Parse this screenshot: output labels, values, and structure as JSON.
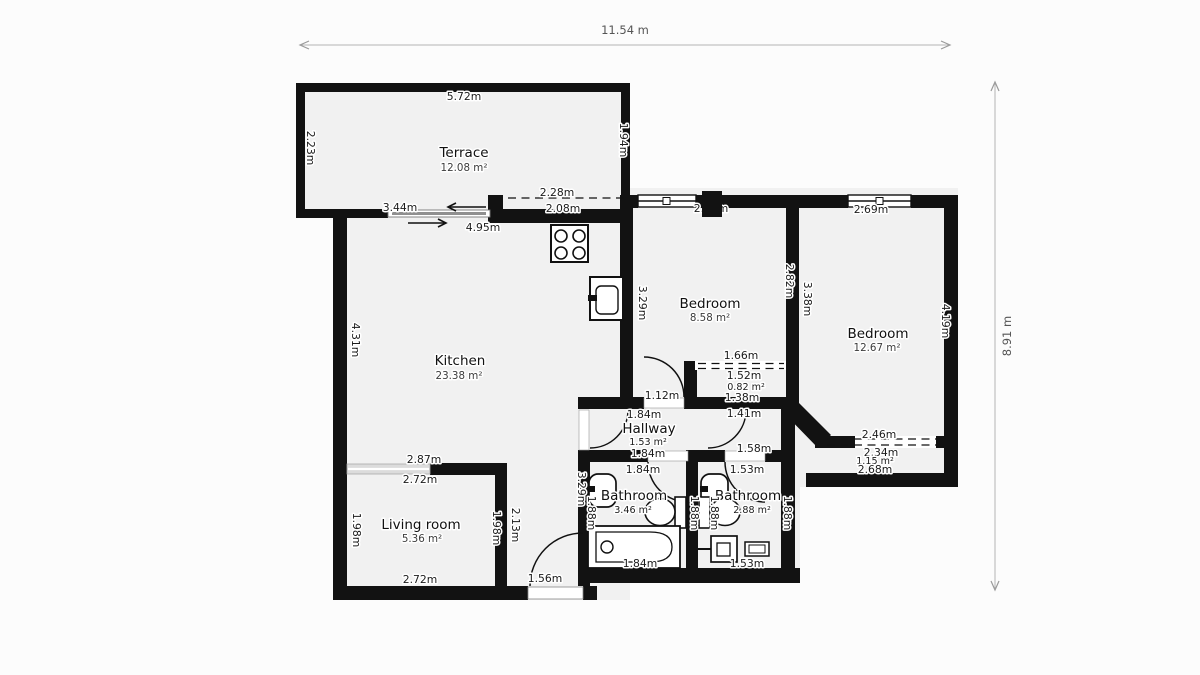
{
  "meta": {
    "width_label": "11.54 m",
    "height_label": "8.91 m"
  },
  "terrace": {
    "name": "Terrace",
    "area": "12.08 m²",
    "dim_top": "5.72m",
    "dim_left": "2.23m",
    "dim_right": "1.94m",
    "dim_door": "3.44m"
  },
  "kitchen": {
    "name": "Kitchen",
    "area": "23.38 m²",
    "dim_top": "4.95m",
    "dim_left": "4.31m",
    "window_outer": "2.28m",
    "window_inner": "2.08m"
  },
  "bedroom1": {
    "name": "Bedroom",
    "area": "8.58 m²",
    "dim_top": "2.78m",
    "dim_left": "3.29m",
    "dim_right": "2.82m"
  },
  "bedroom2": {
    "name": "Bedroom",
    "area": "12.67 m²",
    "dim_top": "2.69m",
    "dim_left": "3.38m",
    "dim_right": "4.19m"
  },
  "closet": {
    "area": "0.82 m²",
    "dim_door": "1.66m",
    "dim_width": "1.52m",
    "dim_bottom": "1.38m"
  },
  "hallway": {
    "name": "Hallway",
    "area": "1.53 m²",
    "dim_door_top": "1.12m",
    "dim_width_top": "1.84m",
    "dim_width_bottom": "1.84m"
  },
  "corridor": {
    "dim_top": "1.41m",
    "dim_door": "1.58m"
  },
  "balcony": {
    "area": "1.15 m²",
    "dim_window": "2.46m",
    "dim_inner": "2.34m",
    "dim_bottom": "2.68m"
  },
  "bathroom1": {
    "name": "Bathroom",
    "area": "3.46 m²",
    "dim_top": "1.84m",
    "dim_bottom": "1.84m",
    "dim_left": "1.88m",
    "dim_right": "1.88m"
  },
  "bathroom2": {
    "name": "Bathroom",
    "area": "2.88 m²",
    "dim_top": "1.53m",
    "dim_bottom": "1.53m",
    "dim_left": "1.88m",
    "dim_right": "1.88m"
  },
  "living_room": {
    "name": "Living room",
    "area": "5.36 m²",
    "dim_outer_top": "2.87m",
    "dim_inner_top": "2.72m",
    "dim_bottom": "2.72m",
    "dim_left": "1.98m",
    "dim_right": "1.98m"
  },
  "entry": {
    "dim_height": "2.13m",
    "dim_wall": "3.29m",
    "dim_door": "1.56m"
  }
}
